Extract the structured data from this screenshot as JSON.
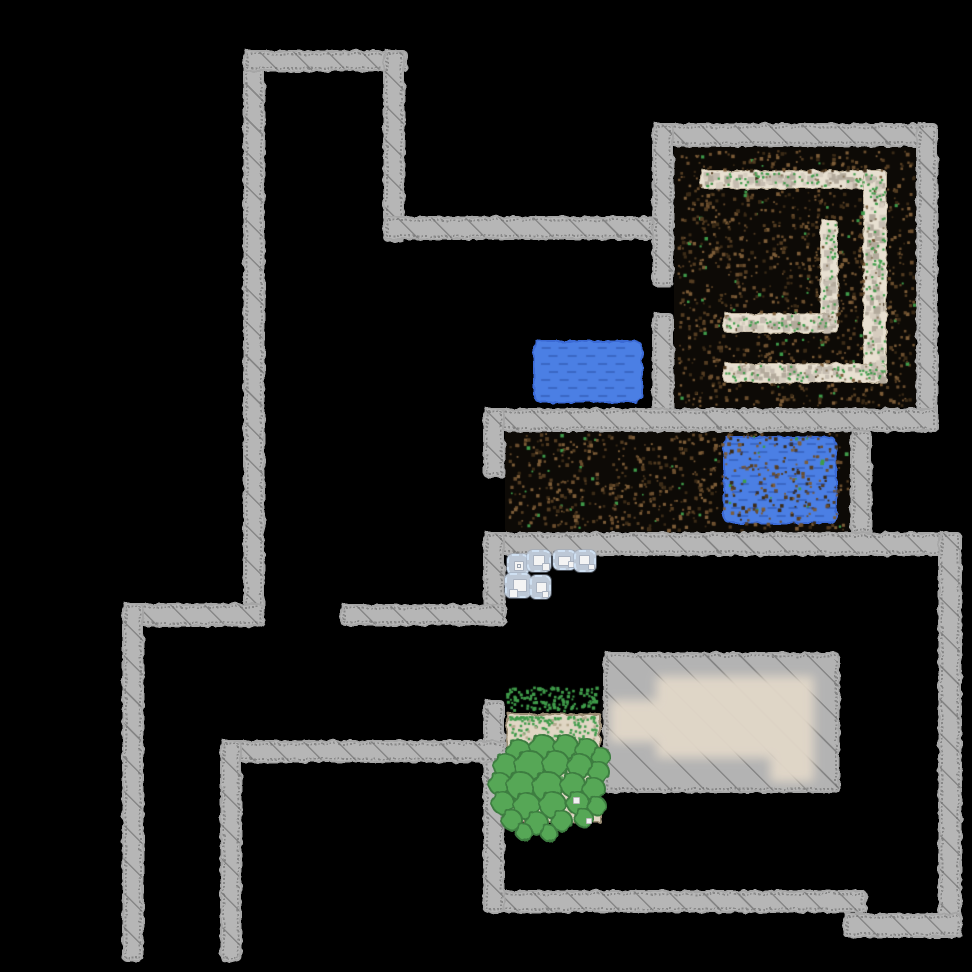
{
  "meta": {
    "view": "explored-game-map",
    "background": "#000000",
    "width": 972,
    "height": 972
  },
  "palette": {
    "wall": "#b6b6b6",
    "wall_hatch": "#606060",
    "dirt": "#0d0a06",
    "dirt_speck": [
      "#6b4e2e",
      "#543d22",
      "#3b2b17",
      "#7d5d38"
    ],
    "grass": "#3f9b4a",
    "path": "#e8e0d1",
    "path_speck": [
      "#c6bdb1",
      "#b3aa9c",
      "#d6cdbf"
    ],
    "path_dark_speck": "#8a7a60",
    "water": "#4b7fe4",
    "water_dash": "rgba(35,62,145,0.38)",
    "sand": "#e0d6c4",
    "sand_speck": "#b5a98f",
    "bush": "#57a757",
    "bush_border": "#3d7d41",
    "item_bg": "#bdc8d6",
    "item_border": "#cfe0f2",
    "item_square": "#f4f4f4",
    "furniture": "#e2d8c9",
    "platform": "#b3b3b3"
  },
  "map": {
    "walls": [
      {
        "id": "tower-west",
        "x": 243,
        "y": 50,
        "w": 22,
        "h": 577
      },
      {
        "id": "tower-north",
        "x": 243,
        "y": 50,
        "w": 165,
        "h": 22
      },
      {
        "id": "tower-east",
        "x": 383,
        "y": 50,
        "w": 22,
        "h": 192
      },
      {
        "id": "arm-east",
        "x": 383,
        "y": 216,
        "w": 271,
        "h": 24
      },
      {
        "id": "room1-north",
        "x": 652,
        "y": 123,
        "w": 286,
        "h": 24
      },
      {
        "id": "room1-west-upper",
        "x": 652,
        "y": 123,
        "w": 22,
        "h": 164
      },
      {
        "id": "room1-west-lower",
        "x": 652,
        "y": 313,
        "w": 22,
        "h": 119
      },
      {
        "id": "room1-east",
        "x": 916,
        "y": 123,
        "w": 22,
        "h": 309
      },
      {
        "id": "room1-south",
        "x": 483,
        "y": 408,
        "w": 455,
        "h": 24
      },
      {
        "id": "room2-west-stub",
        "x": 483,
        "y": 408,
        "w": 22,
        "h": 70
      },
      {
        "id": "room2-east-divider",
        "x": 850,
        "y": 430,
        "w": 22,
        "h": 104
      },
      {
        "id": "room3-north",
        "x": 483,
        "y": 532,
        "w": 479,
        "h": 24
      },
      {
        "id": "map-east",
        "x": 938,
        "y": 532,
        "w": 24,
        "h": 406
      },
      {
        "id": "room3-south",
        "x": 483,
        "y": 890,
        "w": 384,
        "h": 23
      },
      {
        "id": "room3-south-step",
        "x": 843,
        "y": 913,
        "w": 119,
        "h": 25
      },
      {
        "id": "room3-west-upper",
        "x": 483,
        "y": 532,
        "w": 22,
        "h": 94
      },
      {
        "id": "room3-west-lower",
        "x": 483,
        "y": 700,
        "w": 22,
        "h": 213
      },
      {
        "id": "corridor-north",
        "x": 340,
        "y": 604,
        "w": 167,
        "h": 22
      },
      {
        "id": "west-arm",
        "x": 122,
        "y": 603,
        "w": 143,
        "h": 24
      },
      {
        "id": "west-wall",
        "x": 122,
        "y": 603,
        "w": 22,
        "h": 359
      },
      {
        "id": "corridor-south",
        "x": 220,
        "y": 740,
        "w": 287,
        "h": 23
      },
      {
        "id": "south-wall",
        "x": 220,
        "y": 740,
        "w": 22,
        "h": 222
      }
    ],
    "floors": [
      {
        "id": "room1-dirt-floor",
        "type": "dirt",
        "x": 674,
        "y": 147,
        "w": 242,
        "h": 261
      },
      {
        "id": "room2-dirt-floor",
        "type": "dirt",
        "x": 505,
        "y": 430,
        "w": 345,
        "h": 102
      },
      {
        "id": "path-top",
        "type": "path",
        "x": 700,
        "y": 170,
        "w": 187,
        "h": 19
      },
      {
        "id": "path-east",
        "type": "path",
        "x": 863,
        "y": 170,
        "w": 24,
        "h": 213
      },
      {
        "id": "path-south",
        "type": "path",
        "x": 723,
        "y": 363,
        "w": 164,
        "h": 20
      },
      {
        "id": "path-inner-vert",
        "type": "path",
        "x": 820,
        "y": 220,
        "w": 18,
        "h": 113
      },
      {
        "id": "path-inner-horz",
        "type": "path",
        "x": 723,
        "y": 313,
        "w": 115,
        "h": 20
      },
      {
        "id": "sand-patch",
        "type": "sand",
        "x": 506,
        "y": 713,
        "w": 95,
        "h": 110
      },
      {
        "id": "grass-scatter",
        "type": "scatter",
        "x": 506,
        "y": 686,
        "w": 94,
        "h": 28
      }
    ],
    "pools": [
      {
        "id": "water-pool-west",
        "x": 533,
        "y": 340,
        "w": 110,
        "h": 63
      },
      {
        "id": "water-pool-east",
        "x": 723,
        "y": 436,
        "w": 114,
        "h": 88
      }
    ],
    "platform": {
      "id": "stone-platform",
      "x": 603,
      "y": 652,
      "w": 237,
      "h": 141
    },
    "furniture": {
      "id": "blurred-structure",
      "parts": [
        {
          "x": 656,
          "y": 676,
          "w": 158,
          "h": 82
        },
        {
          "x": 770,
          "y": 740,
          "w": 44,
          "h": 42
        },
        {
          "x": 610,
          "y": 700,
          "w": 48,
          "h": 42
        }
      ]
    },
    "items": [
      {
        "x": 507,
        "y": 554,
        "w": 22,
        "h": 21,
        "squares": [
          {
            "x": 5,
            "y": 5,
            "w": 10,
            "h": 10,
            "outlined": true
          }
        ]
      },
      {
        "x": 527,
        "y": 550,
        "w": 24,
        "h": 22,
        "squares": [
          {
            "x": 4,
            "y": 3,
            "w": 12,
            "h": 11
          },
          {
            "x": 13,
            "y": 11,
            "w": 8,
            "h": 8
          }
        ]
      },
      {
        "x": 553,
        "y": 550,
        "w": 23,
        "h": 20,
        "squares": [
          {
            "x": 3,
            "y": 4,
            "w": 13,
            "h": 10
          },
          {
            "x": 13,
            "y": 9,
            "w": 7,
            "h": 7
          }
        ]
      },
      {
        "x": 574,
        "y": 550,
        "w": 22,
        "h": 22,
        "squares": [
          {
            "x": 3,
            "y": 3,
            "w": 11,
            "h": 10
          },
          {
            "x": 12,
            "y": 12,
            "w": 7,
            "h": 6
          }
        ]
      },
      {
        "x": 505,
        "y": 573,
        "w": 26,
        "h": 25,
        "squares": [
          {
            "x": 6,
            "y": 4,
            "w": 14,
            "h": 13
          },
          {
            "x": 2,
            "y": 14,
            "w": 9,
            "h": 9
          }
        ]
      },
      {
        "x": 530,
        "y": 575,
        "w": 21,
        "h": 24,
        "squares": [
          {
            "x": 4,
            "y": 5,
            "w": 11,
            "h": 11
          },
          {
            "x": 10,
            "y": 14,
            "w": 7,
            "h": 7
          }
        ]
      }
    ],
    "bushes": [
      {
        "cx": 519,
        "cy": 752,
        "r": 13
      },
      {
        "cx": 543,
        "cy": 748,
        "r": 14
      },
      {
        "cx": 566,
        "cy": 747,
        "r": 13
      },
      {
        "cx": 587,
        "cy": 750,
        "r": 12
      },
      {
        "cx": 601,
        "cy": 757,
        "r": 10
      },
      {
        "cx": 506,
        "cy": 766,
        "r": 13
      },
      {
        "cx": 530,
        "cy": 766,
        "r": 16
      },
      {
        "cx": 556,
        "cy": 764,
        "r": 14
      },
      {
        "cx": 580,
        "cy": 766,
        "r": 13
      },
      {
        "cx": 599,
        "cy": 772,
        "r": 11
      },
      {
        "cx": 500,
        "cy": 784,
        "r": 12
      },
      {
        "cx": 521,
        "cy": 786,
        "r": 15
      },
      {
        "cx": 548,
        "cy": 787,
        "r": 16
      },
      {
        "cx": 573,
        "cy": 785,
        "r": 13
      },
      {
        "cx": 594,
        "cy": 789,
        "r": 12
      },
      {
        "cx": 503,
        "cy": 803,
        "r": 12
      },
      {
        "cx": 527,
        "cy": 806,
        "r": 14
      },
      {
        "cx": 553,
        "cy": 805,
        "r": 14
      },
      {
        "cx": 578,
        "cy": 803,
        "r": 12
      },
      {
        "cx": 597,
        "cy": 806,
        "r": 10
      },
      {
        "cx": 512,
        "cy": 820,
        "r": 11
      },
      {
        "cx": 537,
        "cy": 823,
        "r": 12
      },
      {
        "cx": 562,
        "cy": 821,
        "r": 11
      },
      {
        "cx": 584,
        "cy": 818,
        "r": 10
      },
      {
        "cx": 524,
        "cy": 832,
        "r": 9
      },
      {
        "cx": 549,
        "cy": 833,
        "r": 9
      }
    ],
    "bush_bits": [
      {
        "x": 573,
        "y": 797,
        "w": 7,
        "h": 7
      },
      {
        "x": 586,
        "y": 818,
        "w": 6,
        "h": 6
      }
    ]
  }
}
